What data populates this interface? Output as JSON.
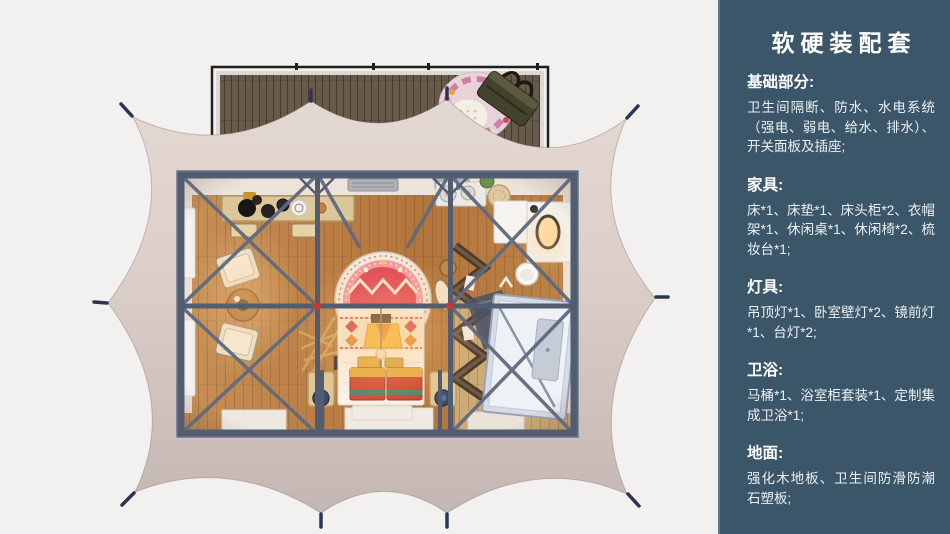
{
  "sidebar": {
    "title": "软硬装配套",
    "sections": [
      {
        "id": "basics",
        "heading": "基础部分:",
        "body": "卫生间隔断、防水、水电系统（强电、弱电、给水、排水）、开关面板及插座;"
      },
      {
        "id": "furniture",
        "heading": "家具:",
        "body": "床*1、床垫*1、床头柜*2、衣帽架*1、休闲桌*1、休闲椅*2、梳妆台*1;"
      },
      {
        "id": "lighting",
        "heading": "灯具:",
        "body": "吊顶灯*1、卧室壁灯*2、镜前灯*1、台灯*2;"
      },
      {
        "id": "bathroom",
        "heading": "卫浴:",
        "body": "马桶*1、浴室柜套装*1、定制集成卫浴*1;"
      },
      {
        "id": "flooring",
        "heading": "地面:",
        "body": "强化木地板、卫生间防滑防潮石塑板;"
      }
    ]
  },
  "illustration": {
    "palette": {
      "canvas_bg": "#f2f1f0",
      "sidebar_bg": "#3b5668",
      "tent_fabric_top": "#e3d7d1",
      "tent_fabric_bottom": "#c5b8b4",
      "steel_frame": "#535d71",
      "wood_floor": "#bb7f46",
      "deck_wood": "#675a4b",
      "accent_red": "#d24050",
      "mandala_pink": "#ef97a3",
      "shower_glass": "#d6dce6"
    }
  }
}
